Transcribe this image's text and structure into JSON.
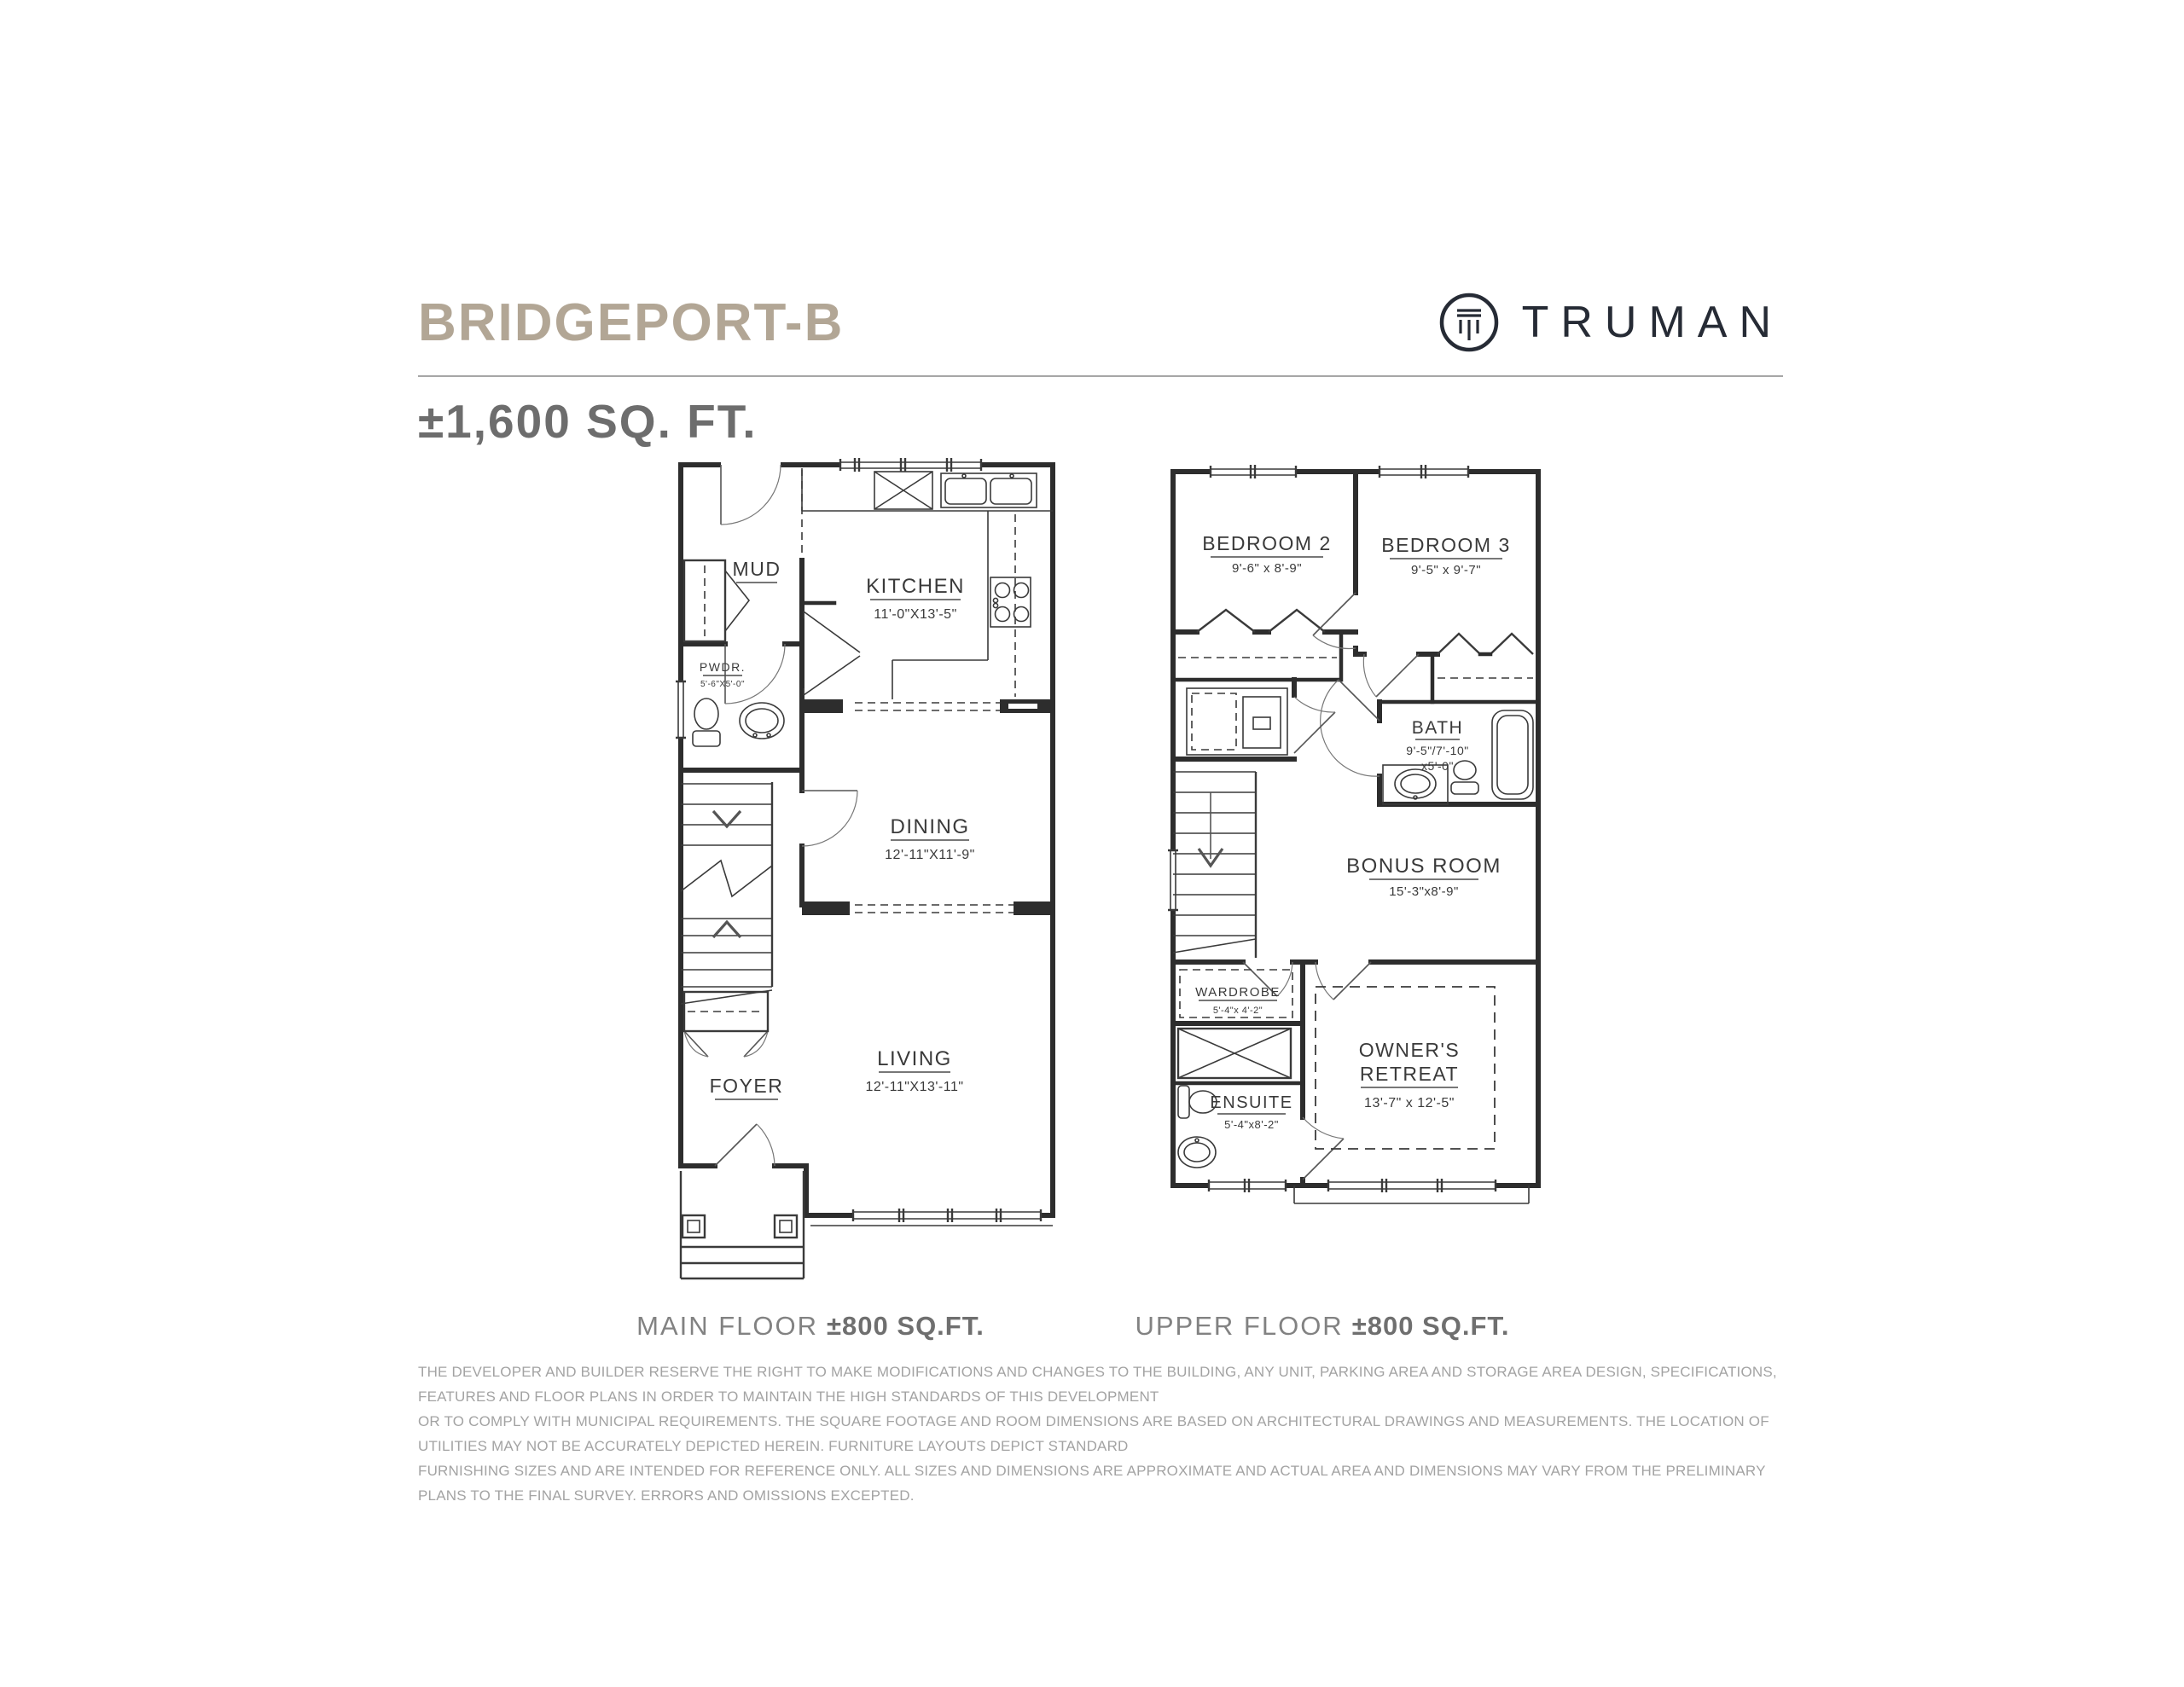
{
  "header": {
    "title": "BRIDGEPORT-B",
    "brand": "TRUMAN",
    "subtitle": "±1,600 SQ. FT."
  },
  "plans": {
    "main": {
      "caption_regular": "MAIN FLOOR",
      "caption_bold": "±800 SQ.FT.",
      "rooms": {
        "mud": {
          "name": "MUD"
        },
        "kitchen": {
          "name": "KITCHEN",
          "dims": "11'-0\"X13'-5\""
        },
        "pwdr": {
          "name": "PWDR.",
          "dims": "5'-6\"X5'-0\""
        },
        "dining": {
          "name": "DINING",
          "dims": "12'-11\"X11'-9\""
        },
        "living": {
          "name": "LIVING",
          "dims": "12'-11\"X13'-11\""
        },
        "foyer": {
          "name": "FOYER"
        }
      }
    },
    "upper": {
      "caption_regular": "UPPER FLOOR",
      "caption_bold": "±800 SQ.FT.",
      "rooms": {
        "bedroom2": {
          "name": "BEDROOM 2",
          "dims": "9'-6\" x 8'-9\""
        },
        "bedroom3": {
          "name": "BEDROOM 3",
          "dims": "9'-5\" x 9'-7\""
        },
        "bath": {
          "name": "BATH",
          "dims": "9'-5\"/7'-10\"",
          "dims2": "x5'-0\""
        },
        "bonus": {
          "name": "BONUS ROOM",
          "dims": "15'-3\"x8'-9\""
        },
        "wardrobe": {
          "name": "WARDROBE",
          "dims": "5'-4\"x 4'-2\""
        },
        "owners": {
          "name_line1": "OWNER'S",
          "name_line2": "RETREAT",
          "dims": "13'-7\" x 12'-5\""
        },
        "ensuite": {
          "name": "ENSUITE",
          "dims": "5'-4\"x8'-2\""
        }
      }
    }
  },
  "disclaimer": {
    "line1": "THE DEVELOPER AND BUILDER RESERVE THE RIGHT TO MAKE MODIFICATIONS AND CHANGES TO THE BUILDING, ANY UNIT, PARKING AREA AND STORAGE AREA DESIGN, SPECIFICATIONS, FEATURES AND FLOOR PLANS IN ORDER TO MAINTAIN THE HIGH STANDARDS OF THIS DEVELOPMENT",
    "line2": "OR TO COMPLY WITH MUNICIPAL REQUIREMENTS. THE SQUARE FOOTAGE AND ROOM DIMENSIONS ARE BASED ON ARCHITECTURAL DRAWINGS AND MEASUREMENTS. THE LOCATION OF UTILITIES MAY NOT BE ACCURATELY DEPICTED HEREIN. FURNITURE LAYOUTS DEPICT STANDARD",
    "line3": "FURNISHING SIZES AND ARE INTENDED FOR REFERENCE ONLY. ALL SIZES AND DIMENSIONS ARE APPROXIMATE AND ACTUAL AREA AND DIMENSIONS MAY VARY FROM THE PRELIMINARY PLANS TO THE FINAL SURVEY. ERRORS AND OMISSIONS EXCEPTED."
  },
  "colors": {
    "title": "#b2a695",
    "brand": "#262b35",
    "subtitle": "#6d6d6d",
    "caption": "#828282",
    "plan_line": "#2d2d2d",
    "disclaimer": "#a3a3a3"
  }
}
